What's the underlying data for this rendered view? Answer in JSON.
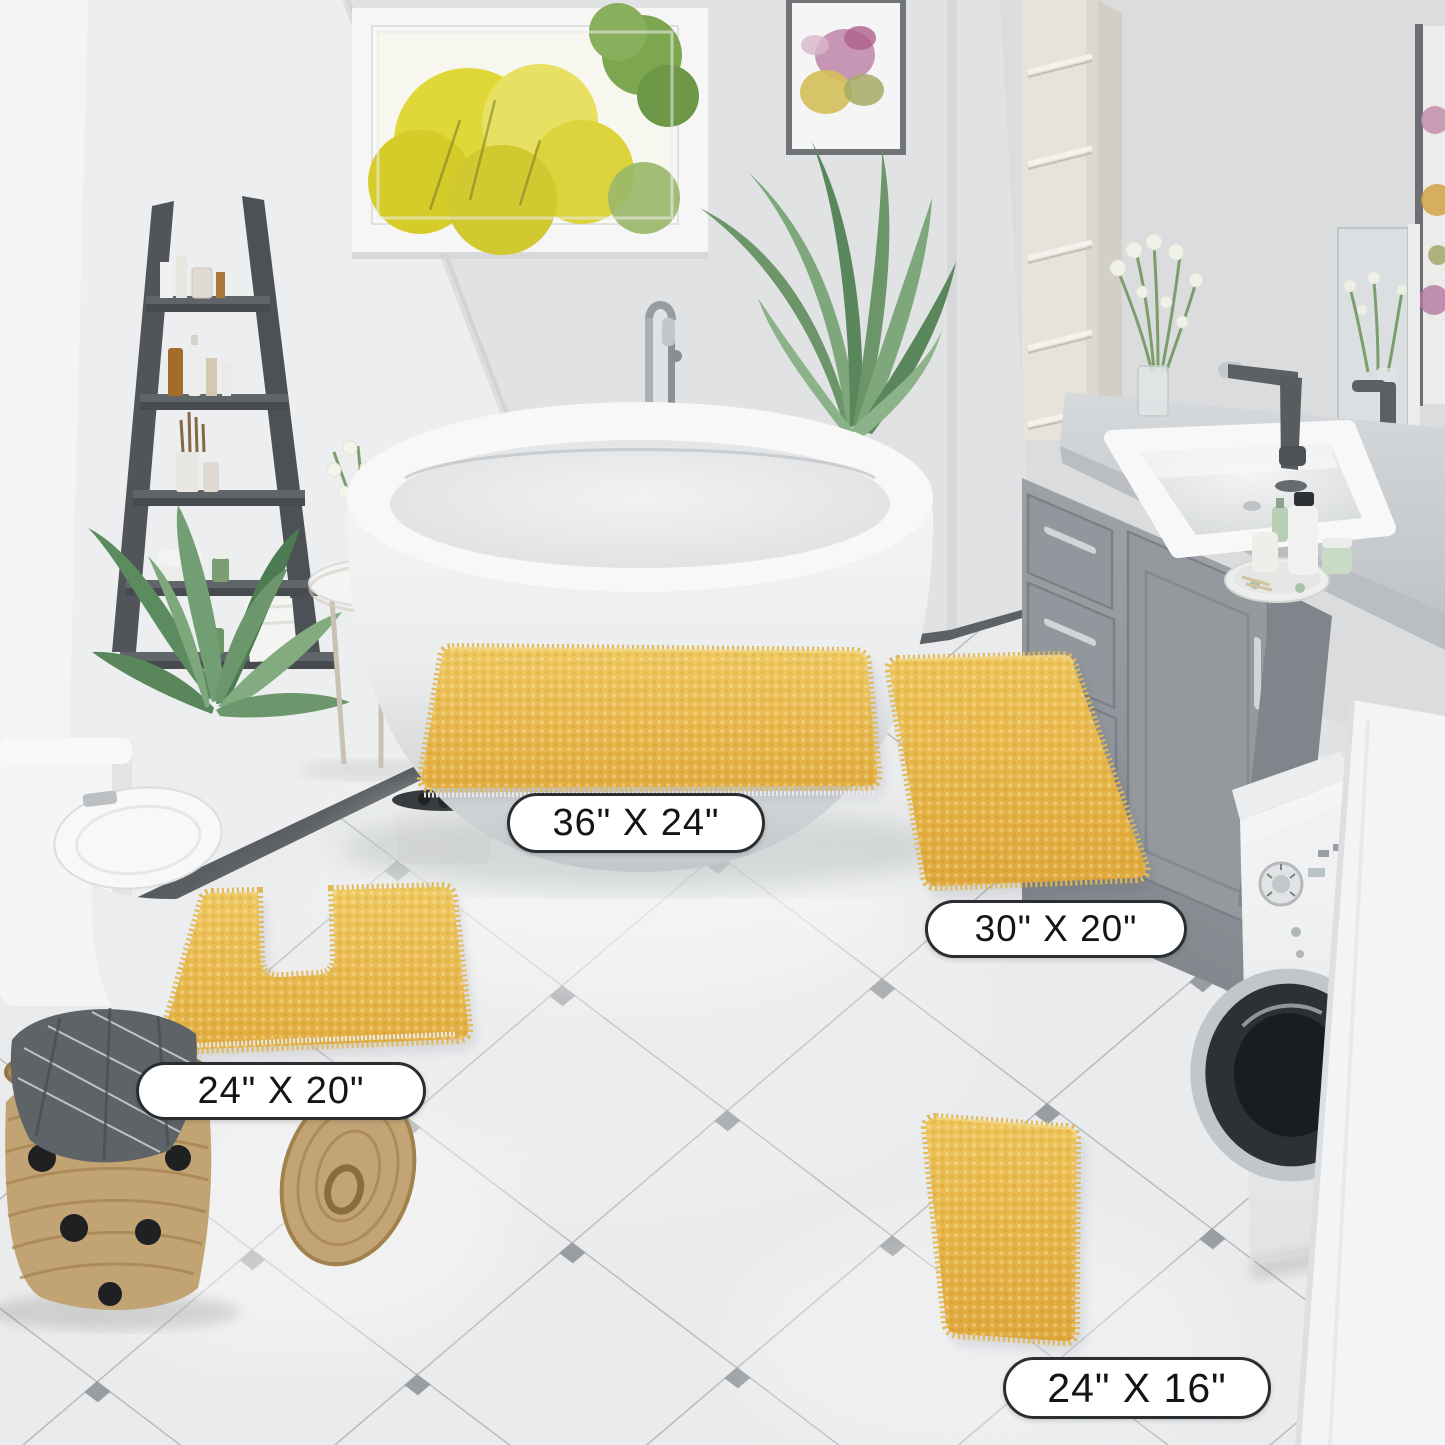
{
  "meta": {
    "content_type": "product lifestyle photo",
    "room": "bathroom with four yellow chenille bath mats"
  },
  "size_labels": [
    {
      "id": "mat-36x24",
      "text": "36\" X 24\""
    },
    {
      "id": "mat-30x20",
      "text": "30\" X 20\""
    },
    {
      "id": "mat-24x20-contour",
      "text": "24\" X 20\""
    },
    {
      "id": "mat-24x16",
      "text": "24\" X 16\""
    }
  ],
  "objects_visible": [
    "window-garden-view",
    "wall-art",
    "ladder-shelf",
    "freestanding-bathtub",
    "floor-faucet",
    "palm-plant",
    "leafy-plant",
    "potted-grass-plant",
    "storage-column",
    "vanity-cabinet",
    "vanity-sink",
    "vanity-faucet",
    "vanity-mirror",
    "flower-vase",
    "toiletries-tray",
    "toilet",
    "side-table",
    "towel-stool",
    "washing-machine",
    "laundry-cabinet",
    "woven-basket",
    "basket-lid",
    "tile-floor",
    "contour-bath-mat",
    "rectangle-bath-mats"
  ],
  "palette": {
    "mat_yellow": "#F2C14E",
    "mat_yellow_deep": "#E3A93C",
    "mat_fringe": "#F6DC8F",
    "wall": "#E8EAEB",
    "wall_bright": "#F5F6F7",
    "floor": "#F1F2F3",
    "tile_grout": "#B4B7BA",
    "tile_diamond": "#8E9397",
    "baseboard_charcoal": "#55595D",
    "ladder_gray": "#54585C",
    "vanity_gray": "#9BA1A6",
    "plant_green": "#6F9A6E",
    "window_foliage_yellow": "#E6DB2E",
    "label_border": "#2B2E31",
    "label_bg": "#FFFFFF",
    "label_text": "#121416"
  }
}
